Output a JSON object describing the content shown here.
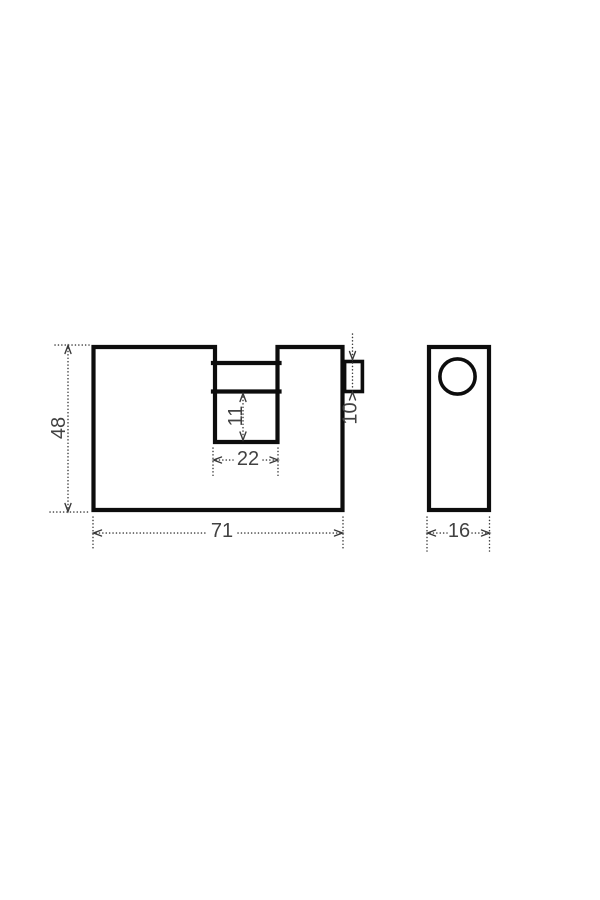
{
  "page": {
    "background": "#ffffff"
  },
  "drawing": {
    "type": "technical-dimension-drawing",
    "subject": "block padlock, front view and side view",
    "outline_color": "#0d0d0d",
    "dimension_color": "#3a3a3a",
    "front_view": {
      "height_label": "48",
      "width_label": "71",
      "notch_width_label": "22",
      "notch_depth_label": "11",
      "shackle_height_label": "10"
    },
    "side_view": {
      "width_label": "16"
    }
  }
}
